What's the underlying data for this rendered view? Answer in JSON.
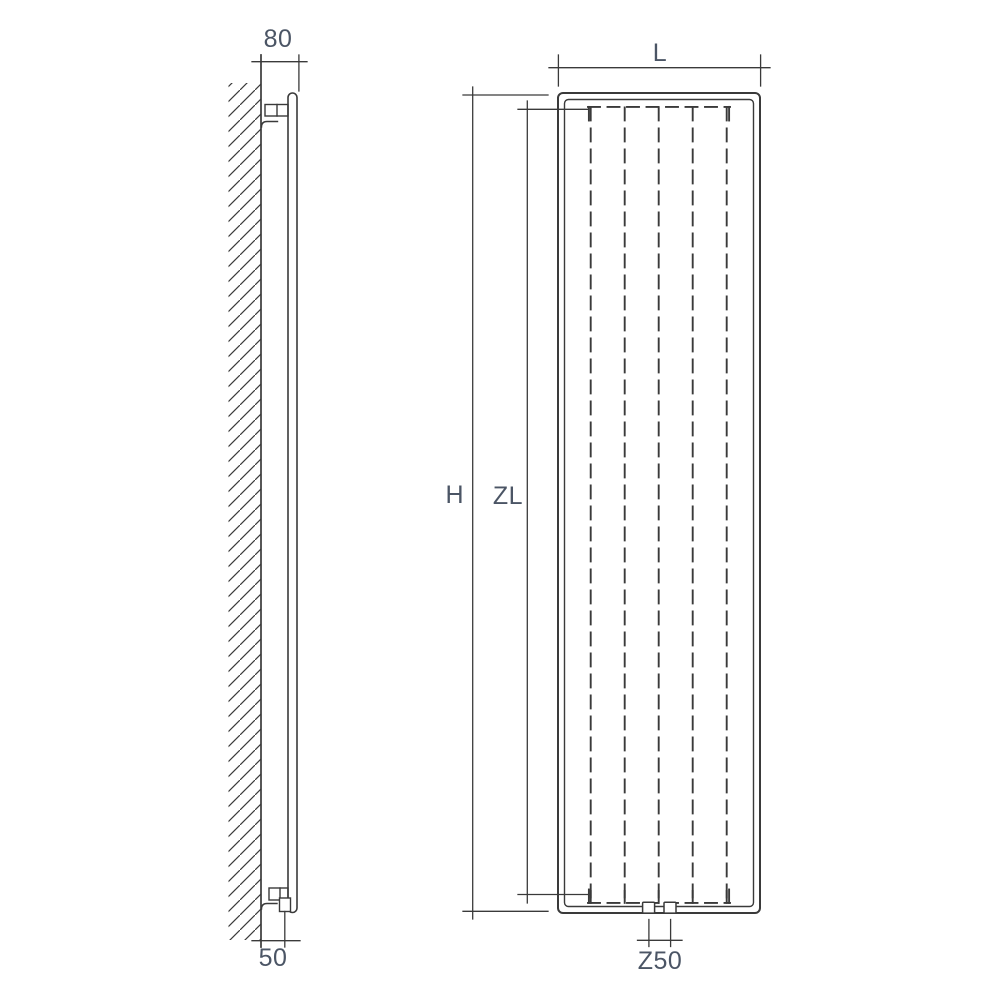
{
  "drawing": {
    "kind": "radiator-installation-technical-diagram",
    "side_view": {
      "labels": {
        "depth_top": "80",
        "wall_clearance_bottom": "50"
      }
    },
    "front_view": {
      "labels": {
        "width": "L",
        "height": "H",
        "element_length": "ZL",
        "connection_spacing": "Z50"
      },
      "heating_element_lines": 5,
      "bottom_connections": 2
    }
  },
  "colors": {
    "line_color": "#3a3a3a",
    "label_color": "#4b5565",
    "hatch_color": "#707070",
    "bg_color": "#ffffff"
  }
}
